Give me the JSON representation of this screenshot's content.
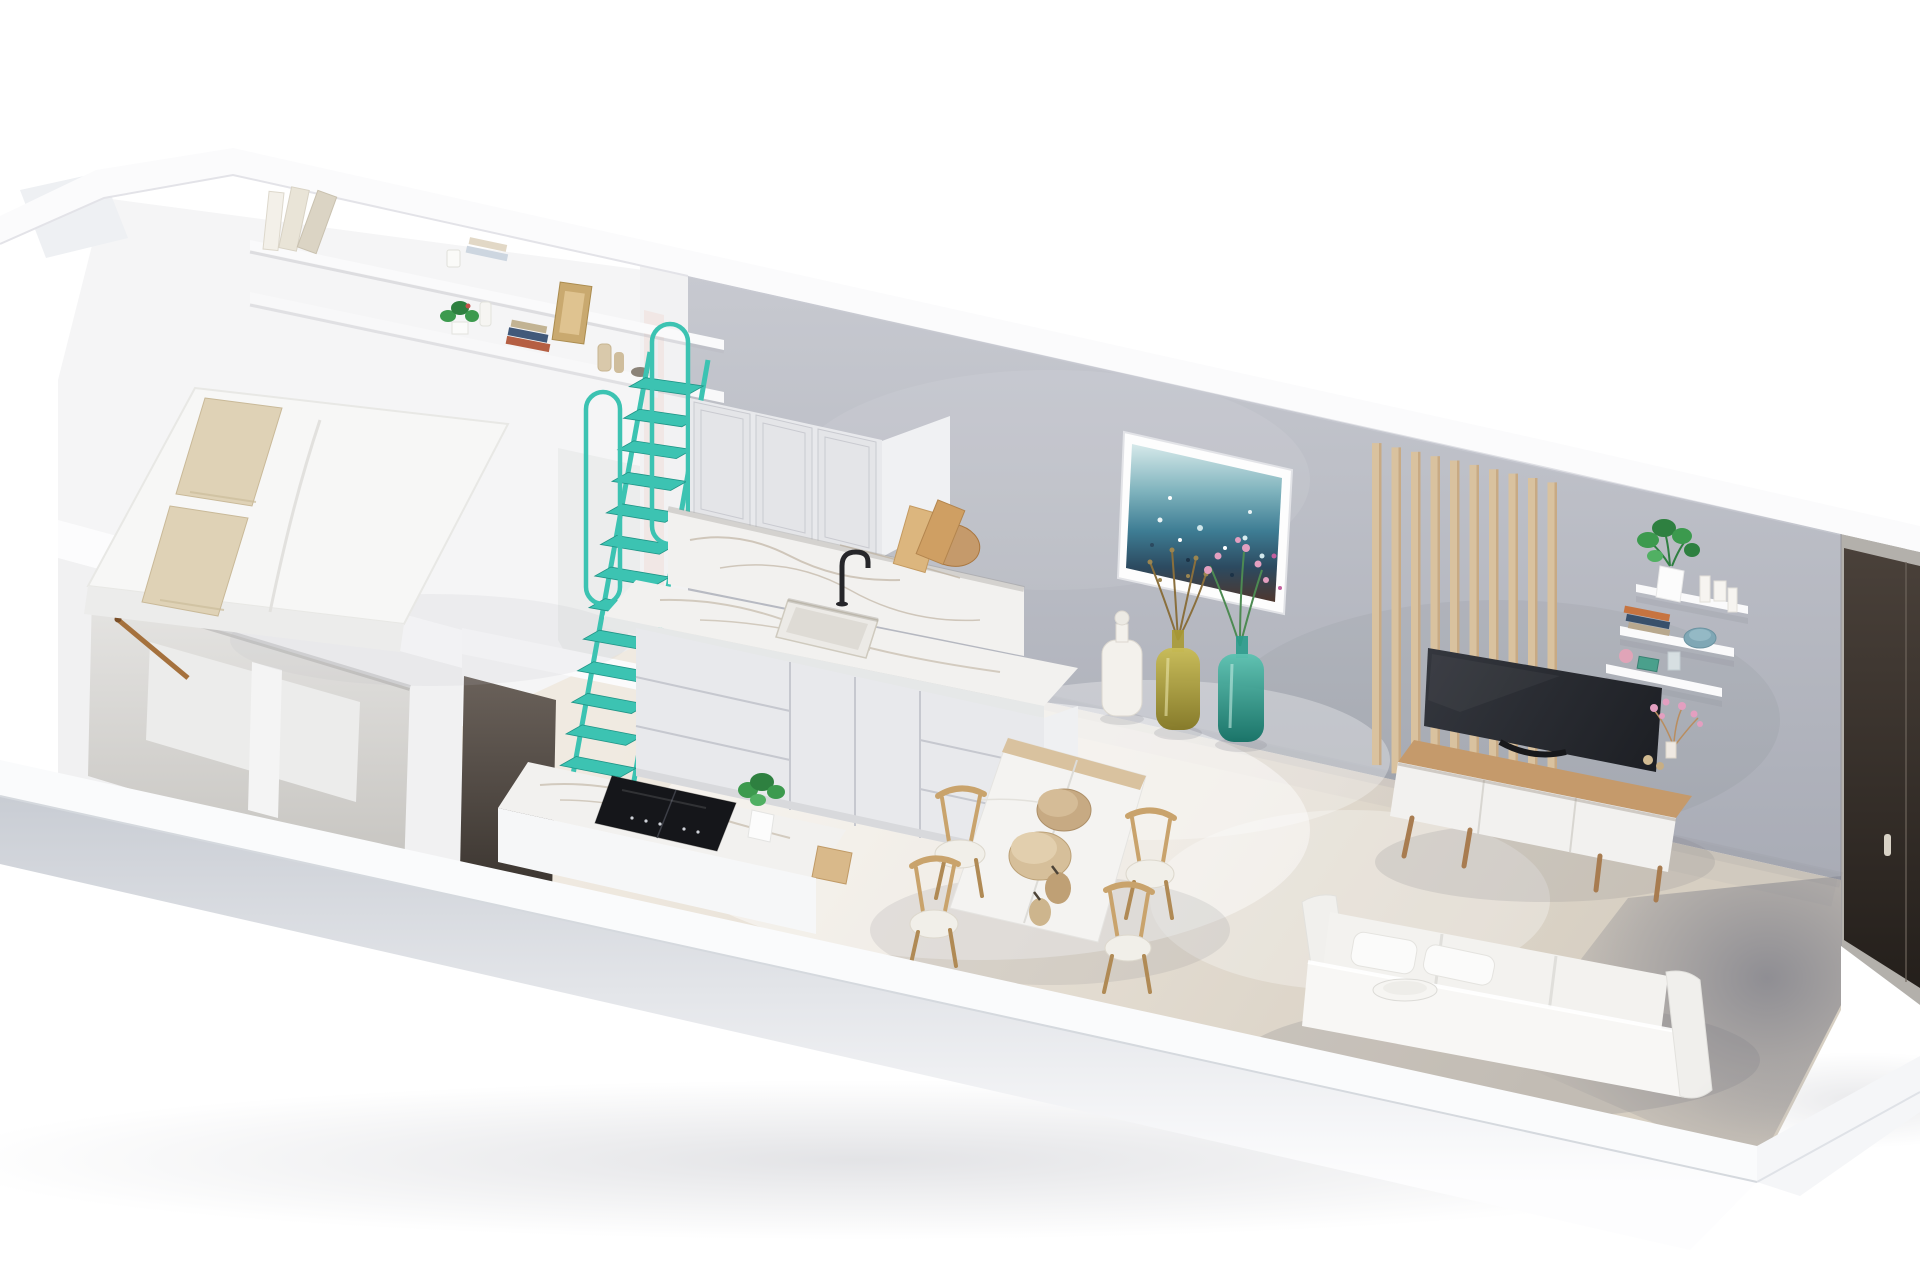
{
  "meta": {
    "description": "Isometric cutaway 3D render of a long narrow studio apartment, viewed from above on a white background. No text is visible in the image.",
    "view": "3d-floorplan-cutaway",
    "visible_text": "none"
  },
  "palette": {
    "background": "#ffffff",
    "wall_top_band": "#fbfbfc",
    "bedroom_white": "#f5f5f6",
    "wall_gray_top": "#c7c9d0",
    "wall_gray_bottom": "#a8abb5",
    "floor_beige_light": "#f0eae1",
    "floor_beige_dark": "#d7cfc2",
    "floor_shadow": "#8b8c97",
    "front_wall_face": "#c9cdd4",
    "accent_teal": "#3cc3b2",
    "teal_dark": "#1f9486",
    "wood_light": "#d9c29f",
    "wood_mid": "#c59a6b",
    "wood_dark": "#a87e52",
    "marble_white": "#f2f1ef",
    "marble_vein": "#b9ab97",
    "cabinet_white": "#e8e9ec",
    "cabinet_line": "#c6c8cf",
    "tv_black": "#26292f",
    "door_dark": "#2e2823",
    "vase_white": "#f3f1ec",
    "vase_yellow": "#b0a13c",
    "vase_teal": "#2a9c8c",
    "pillow_beige": "#dfd2b6",
    "mattress_white": "#f7f7f6",
    "plant_green": "#3c9a4e",
    "plant_green_dark": "#2e8040",
    "flower_pink": "#e39fc0",
    "sofa_white": "#f3f2ef",
    "painting_sky": "#cfe6e8",
    "painting_teal": "#4a8aa0",
    "painting_navy": "#2c4a60",
    "painting_rust": "#4e372e"
  },
  "counts": {
    "wall_slats": 10,
    "ladder_steps": 13,
    "dining_chairs": 4,
    "floor_vases": 3,
    "floating_shelves": 3,
    "upper_cabinet_doors": 3,
    "base_cabinet_sections": 3,
    "bed_pillows": 2,
    "dining_bowls": 4
  },
  "scene": {
    "rooms": [
      {
        "name": "sleeping-loft"
      },
      {
        "name": "kitchen"
      },
      {
        "name": "dining-area"
      },
      {
        "name": "living-area"
      },
      {
        "name": "entry"
      }
    ],
    "objects": [
      {
        "name": "double-bed",
        "detail": "white mattress with two beige pillows on raised loft platform"
      },
      {
        "name": "wall-shelf",
        "detail": "two-tier shelf above bed with leaning books, plants, frames and bottles"
      },
      {
        "name": "open-closet",
        "detail": "niche under loft with wooden hanging rail"
      },
      {
        "name": "loft-ladder",
        "detail": "teal metal ship ladder with two handrail loops"
      },
      {
        "name": "kitchen-upper-cabinets",
        "detail": "three shaker doors"
      },
      {
        "name": "kitchen-counter",
        "detail": "white marble worktop and backsplash with sink and black faucet"
      },
      {
        "name": "kitchen-base-cabinets",
        "detail": "drawer and door fronts"
      },
      {
        "name": "cutting-boards",
        "detail": "wooden boards leaning at counter end"
      },
      {
        "name": "kitchen-island",
        "detail": "marble top with black induction cooktop and potted plant"
      },
      {
        "name": "dining-table",
        "detail": "marble top with wood edge and four decorative bowls"
      },
      {
        "name": "dining-chairs",
        "detail": "four light wood chairs"
      },
      {
        "name": "abstract-sea-painting",
        "detail": "blue ocean artwork in white frame on gray wall"
      },
      {
        "name": "floor-vases",
        "detail": "white, olive-yellow and teal glass bottles with branches and pink flowers"
      },
      {
        "name": "wood-slat-panel",
        "detail": "vertical light wood slats on gray wall"
      },
      {
        "name": "floating-shelves",
        "detail": "three white shelves with monstera plant, candles, books, blue bowl"
      },
      {
        "name": "tv",
        "detail": "large dark flatscreen leaning on wall"
      },
      {
        "name": "tv-console",
        "detail": "wood top sideboard with marble fronts and angled legs"
      },
      {
        "name": "sofa",
        "detail": "white sofa with cushions along front wall"
      },
      {
        "name": "entry-door",
        "detail": "dark door on right end wall with metal handle"
      }
    ]
  }
}
